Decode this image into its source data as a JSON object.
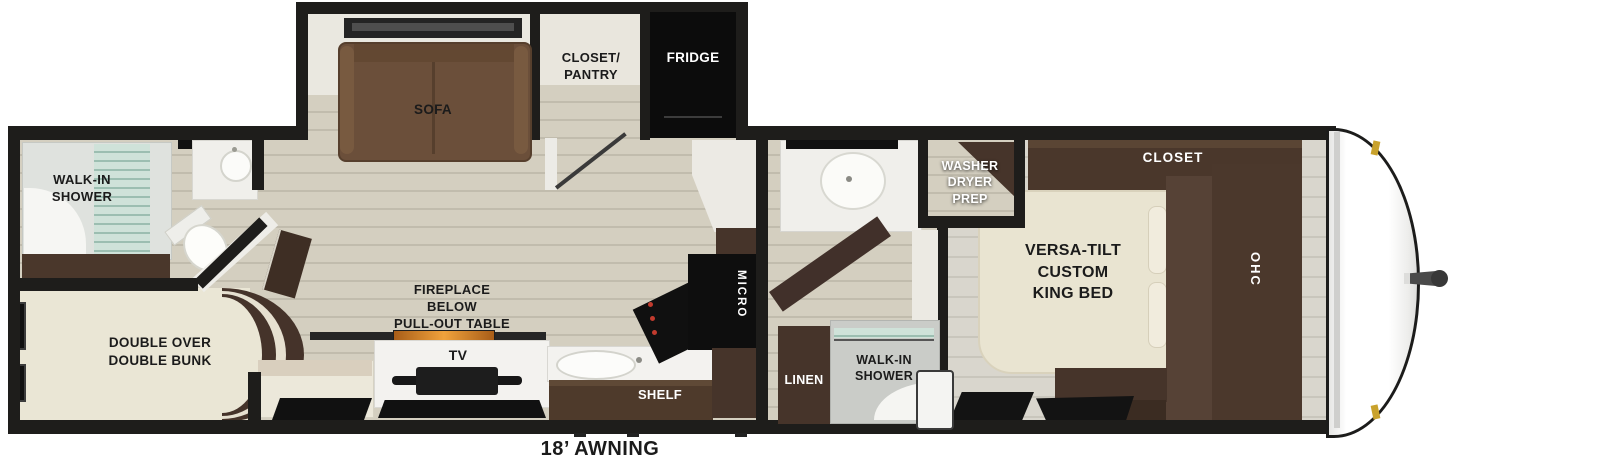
{
  "title": "travel-trailer-floorplan",
  "labels": {
    "rear_shower": "WALK-IN\nSHOWER",
    "bunk": "DOUBLE OVER\nDOUBLE BUNK",
    "sofa": "SOFA",
    "pantry": "CLOSET/\nPANTRY",
    "fridge": "FRIDGE",
    "fireplace": "FIREPLACE\nBELOW\nPULL-OUT TABLE",
    "tv": "TV",
    "shelf": "SHELF",
    "micro": "MICRO",
    "linen": "LINEN",
    "mid_shower": "WALK-IN\nSHOWER",
    "washer": "WASHER\nDRYER\nPREP",
    "bed": "VERSA-TILT\nCUSTOM\nKING BED",
    "closet": "CLOSET",
    "ohc": "OHC",
    "awning": "18’ AWNING"
  },
  "colors": {
    "wall": "#1e1d1b",
    "floor": "#d4cfc0",
    "bedroom_floor": "#d9d6cd",
    "bunk_cream": "#eae6d5",
    "cabinet_brown": "#4a372b",
    "sofa_brown": "#6b4f3a",
    "appliance_black": "#111111",
    "counter_white": "#f3f2ef",
    "shower_glass": "#a9c6bb",
    "fireplace_amber": "#e89b35",
    "clearance_light": "#c9a22c"
  }
}
